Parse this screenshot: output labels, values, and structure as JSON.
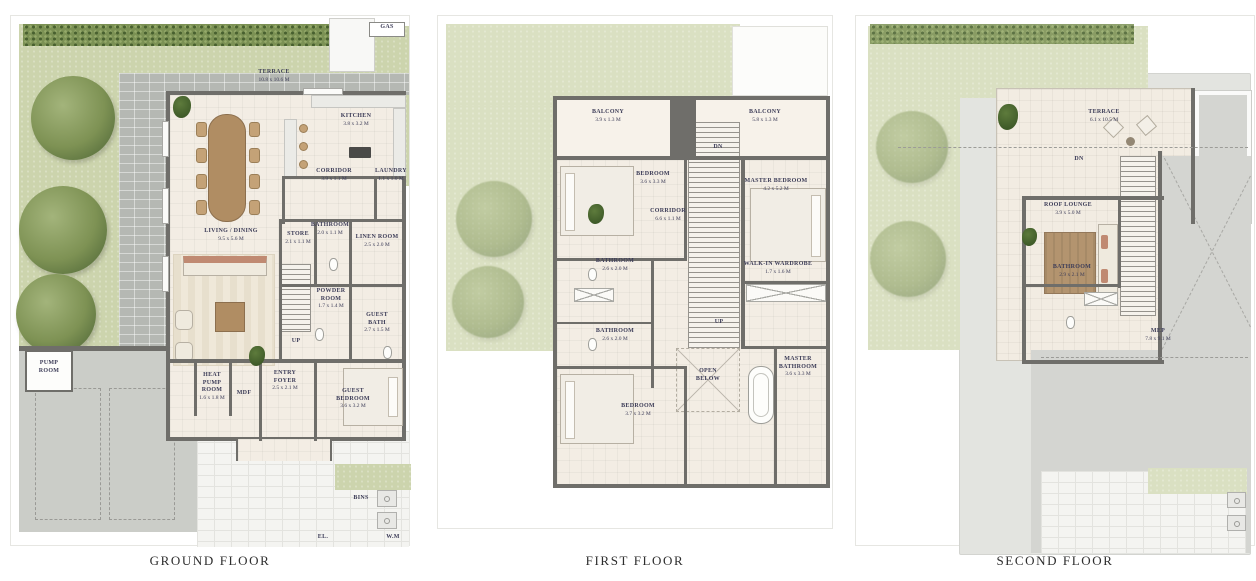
{
  "palette": {
    "wall": "#6f6e6a",
    "grass": "#ccd4ad",
    "hedge": "#7b9154",
    "paver": "#b5b8b3",
    "room_floor": "#f3ede4",
    "concrete": "#d4d5d1",
    "label_ink": "#3d3d58",
    "wood": "#b08d63",
    "coral": "#c08a72"
  },
  "titles": {
    "ground": "GROUND FLOOR",
    "first": "FIRST FLOOR",
    "second": "SECOND FLOOR"
  },
  "ground": {
    "terrace": {
      "name": "TERRACE",
      "dims": "10.8 x 10.6 M"
    },
    "kitchen": {
      "name": "KITCHEN",
      "dims": "3.8 x 3.2 M"
    },
    "corridor": {
      "name": "CORRIDOR",
      "dims": "3.9 x 1.1 M"
    },
    "laundry": {
      "name": "LAUNDRY",
      "dims": "1.1 x 1.0 M"
    },
    "living_dining": {
      "name": "LIVING / DINING",
      "dims": "9.5 x 5.6 M"
    },
    "store": {
      "name": "STORE",
      "dims": "2.1 x 1.1 M"
    },
    "bathroom": {
      "name": "BATHROOM",
      "dims": "2.0 x 1.1 M"
    },
    "linen_room": {
      "name": "LINEN ROOM",
      "dims": "2.5 x 2.0 M"
    },
    "powder_room": {
      "name": "POWDER ROOM",
      "dims": "1.7 x 1.4 M"
    },
    "guest_bath": {
      "name": "GUEST BATH",
      "dims": "2.7 x 1.5 M"
    },
    "pump_room": {
      "name": "PUMP ROOM"
    },
    "heat_pump_room": {
      "name": "HEAT PUMP ROOM",
      "dims": "1.6 x 1.8 M"
    },
    "mdf": "MDF",
    "entry_foyer": {
      "name": "ENTRY FOYER",
      "dims": "2.5 x 2.1 M"
    },
    "guest_bedroom": {
      "name": "GUEST BEDROOM",
      "dims": "3.6 x 3.2 M"
    },
    "up": "UP",
    "gas": "GAS",
    "bins": "BINS",
    "el": "EL.",
    "wm": "W.M"
  },
  "first": {
    "balcony_left": {
      "name": "BALCONY",
      "dims": "3.9 x 1.3 M"
    },
    "balcony_right": {
      "name": "BALCONY",
      "dims": "5.8 x 1.3 M"
    },
    "bedroom_2": {
      "name": "BEDROOM",
      "dims": "3.6 x 3.3 M"
    },
    "master_bedroom": {
      "name": "MASTER BEDROOM",
      "dims": "4.2 x 5.2 M"
    },
    "corridor": {
      "name": "CORRIDOR",
      "dims": "6.6 x 1.1 M"
    },
    "bathroom_upper": {
      "name": "BATHROOM",
      "dims": "2.6 x 2.0 M"
    },
    "bathroom_lower": {
      "name": "BATHROOM",
      "dims": "2.6 x 2.0 M"
    },
    "walk_in_wardrobe": {
      "name": "WALK-IN WARDROBE",
      "dims": "1.7 x 1.6 M"
    },
    "open_below": "OPEN BELOW",
    "master_bathroom": {
      "name": "MASTER BATHROOM",
      "dims": "3.6 x 3.3 M"
    },
    "bedroom_3": {
      "name": "BEDROOM",
      "dims": "3.7 x 3.2 M"
    },
    "dn": "DN",
    "up": "UP"
  },
  "second": {
    "terrace": {
      "name": "TERRACE",
      "dims": "6.1 x 10.5 M"
    },
    "roof_lounge": {
      "name": "ROOF LOUNGE",
      "dims": "3.9 x 5.0 M"
    },
    "bathroom": {
      "name": "BATHROOM",
      "dims": "2.9 x 2.1 M"
    },
    "mep": {
      "name": "MEP",
      "dims": "7.8 x 9.1 M"
    },
    "dn": "DN"
  }
}
